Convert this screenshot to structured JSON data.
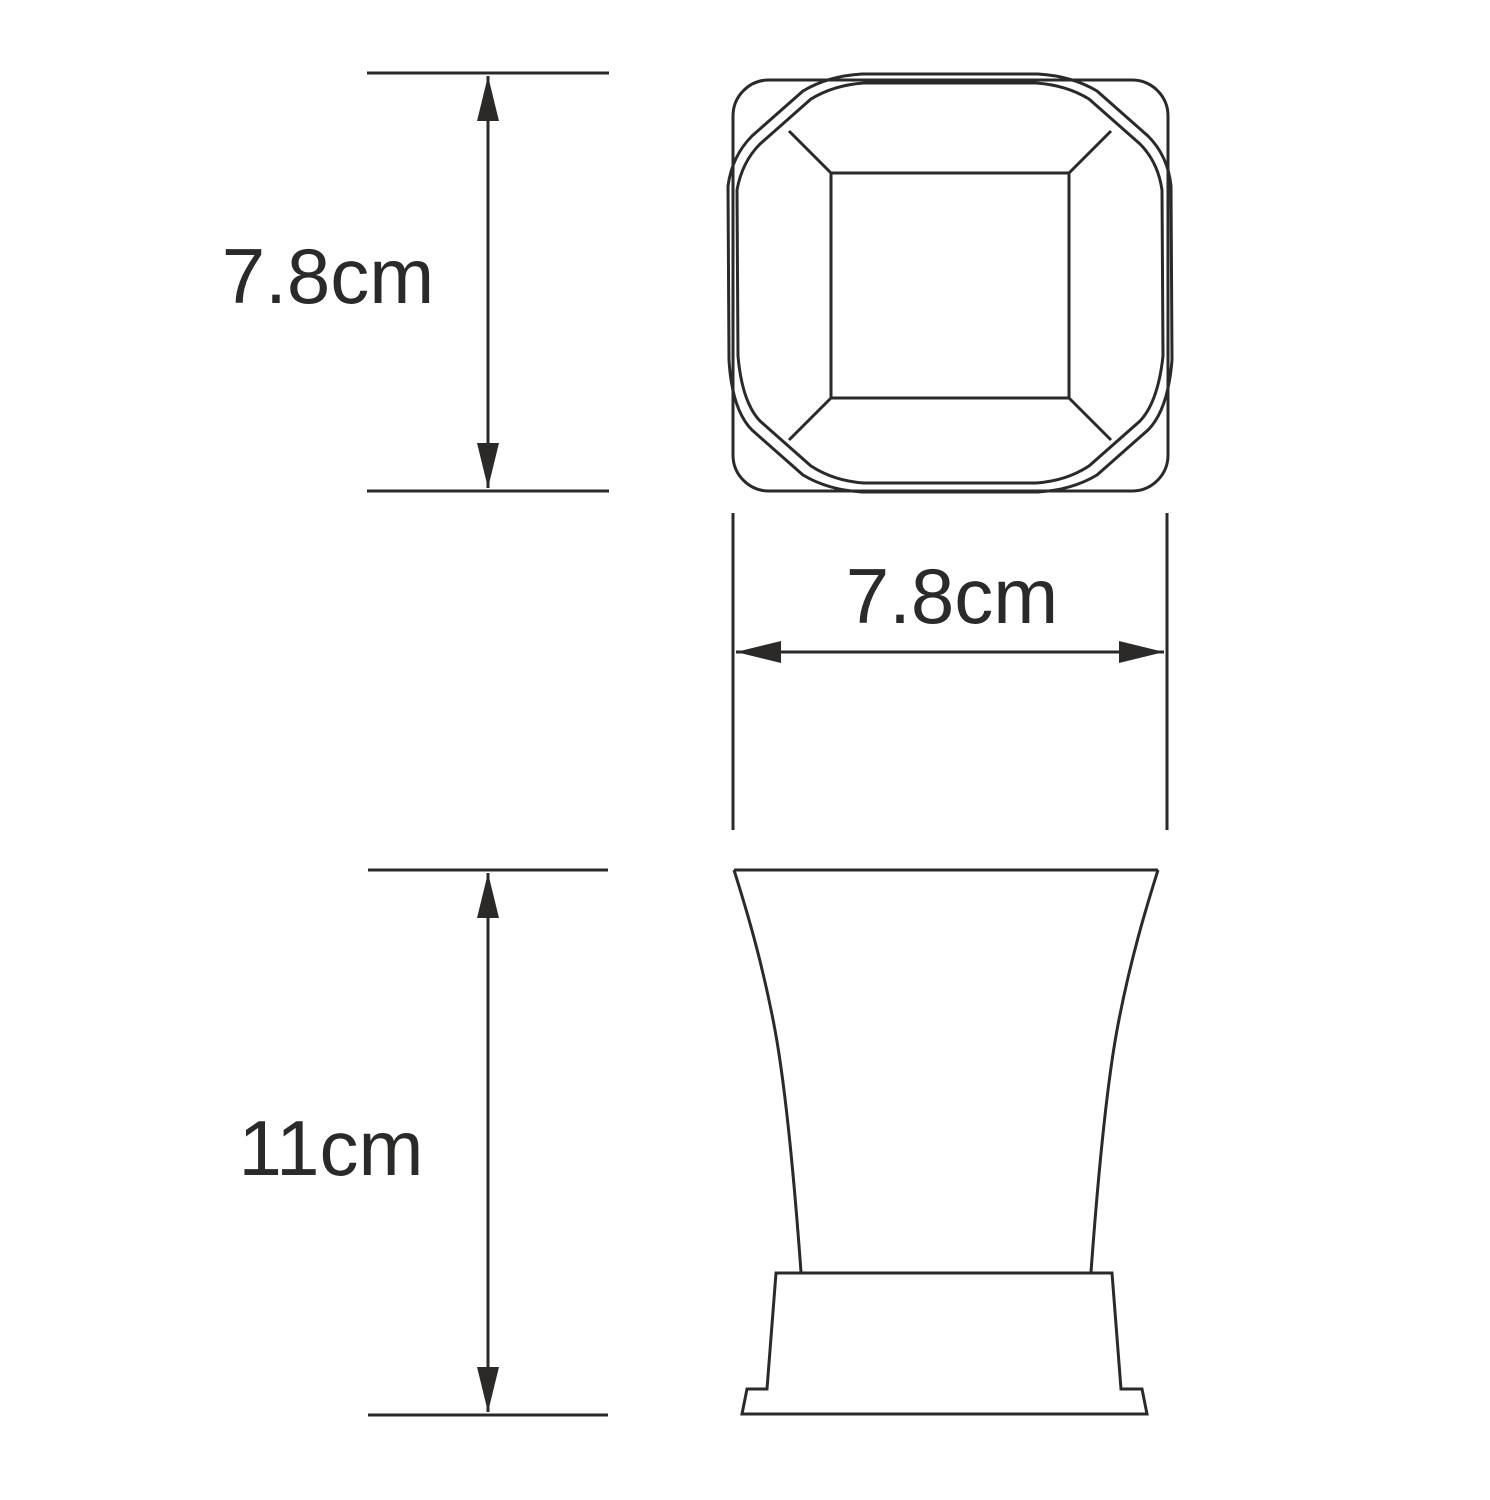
{
  "drawing": {
    "background": "#ffffff",
    "line_color": "#2b2a29",
    "dimensions": {
      "top_view_height": {
        "label": "7.8cm"
      },
      "top_view_width": {
        "label": "7.8cm"
      },
      "front_view_height": {
        "label": "11cm"
      }
    }
  }
}
